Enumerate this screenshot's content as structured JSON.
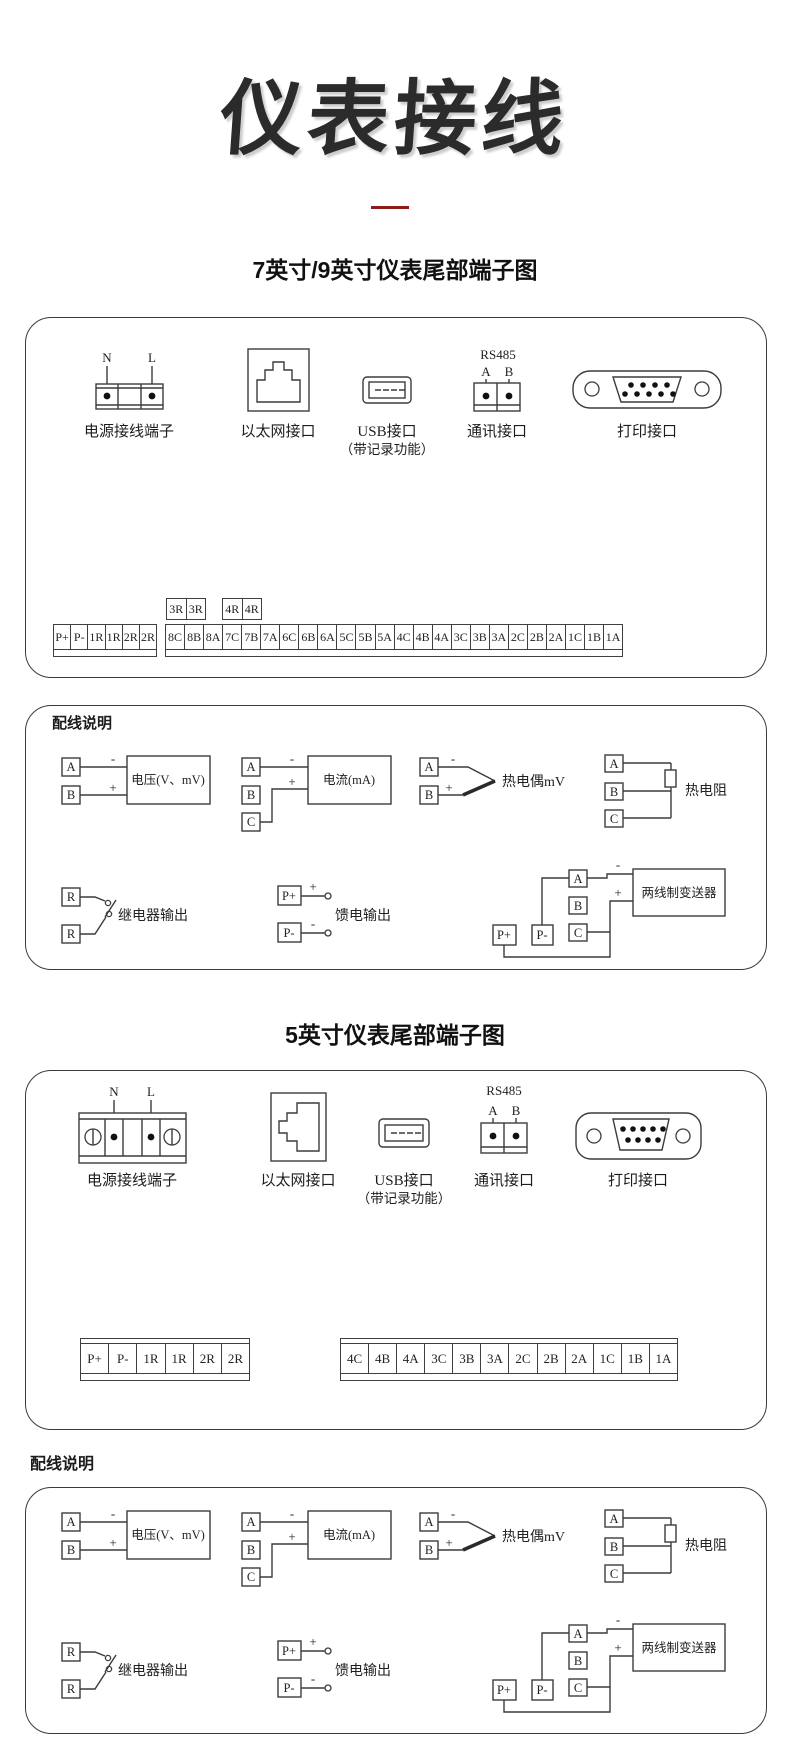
{
  "page": {
    "title": "仪表接线",
    "section7": "7英寸/9英寸仪表尾部端子图",
    "section5": "5英寸仪表尾部端子图",
    "wiring_note_label": "配线说明"
  },
  "connectors": {
    "power_label": "电源接线端子",
    "ethernet_label": "以太网接口",
    "usb_label": "USB接口",
    "usb_label2": "（带记录功能）",
    "comm_label": "通讯接口",
    "print_label": "打印接口",
    "rs485": "RS485",
    "n": "N",
    "l": "L",
    "a": "A",
    "b": "B"
  },
  "terminals7": {
    "relay_pair_1": [
      "3R",
      "3R"
    ],
    "relay_pair_2": [
      "4R",
      "4R"
    ],
    "left": [
      "P+",
      "P-",
      "1R",
      "1R",
      "2R",
      "2R"
    ],
    "main": [
      "8C",
      "8B",
      "8A",
      "7C",
      "7B",
      "7A",
      "6C",
      "6B",
      "6A",
      "5C",
      "5B",
      "5A",
      "4C",
      "4B",
      "4A",
      "3C",
      "3B",
      "3A",
      "2C",
      "2B",
      "2A",
      "1C",
      "1B",
      "1A"
    ]
  },
  "terminals5": {
    "left": [
      "P+",
      "P-",
      "1R",
      "1R",
      "2R",
      "2R"
    ],
    "main": [
      "4C",
      "4B",
      "4A",
      "3C",
      "3B",
      "3A",
      "2C",
      "2B",
      "2A",
      "1C",
      "1B",
      "1A"
    ]
  },
  "wiring": {
    "voltage": {
      "a": "A",
      "b": "B",
      "label": "电压(V、mV)",
      "plus": "+",
      "minus": "-"
    },
    "current": {
      "a": "A",
      "b": "B",
      "c": "C",
      "label": "电流(mA)",
      "plus": "+",
      "minus": "-"
    },
    "thermocouple": {
      "a": "A",
      "b": "B",
      "label": "热电偶mV",
      "plus": "+",
      "minus": "-"
    },
    "rtd": {
      "a": "A",
      "b": "B",
      "c": "C",
      "label": "热电阻"
    },
    "relay": {
      "r1": "R",
      "r2": "R",
      "label": "继电器输出"
    },
    "feed": {
      "p1": "P+",
      "p2": "P-",
      "label": "馈电输出",
      "plus": "+",
      "minus": "-"
    },
    "transmitter": {
      "p1": "P+",
      "p2": "P-",
      "a": "A",
      "b": "B",
      "c": "C",
      "label": "两线制变送器",
      "plus": "+",
      "minus": "-"
    }
  },
  "colors": {
    "accent_red": "#8e1c1c",
    "ink": "#2b2b2b"
  }
}
